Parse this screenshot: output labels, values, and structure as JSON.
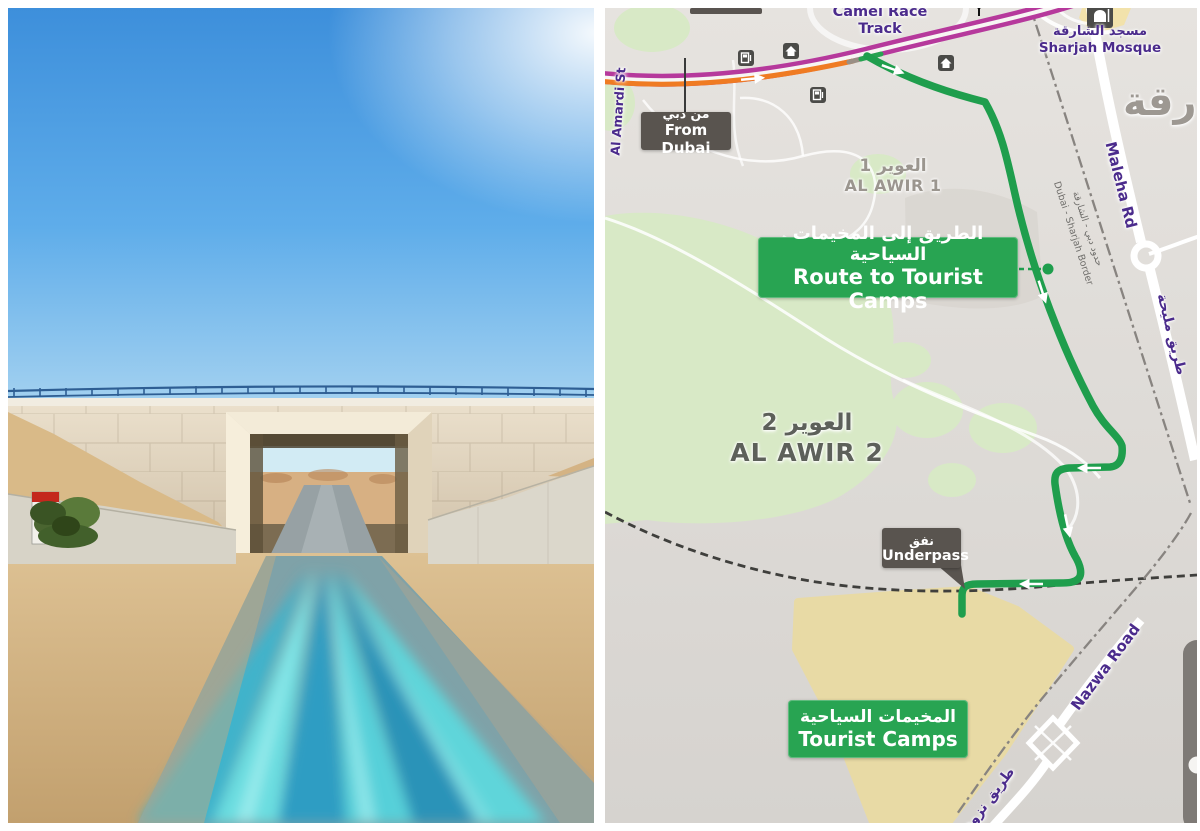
{
  "panels": {
    "left": "road-photo",
    "right": "route-map"
  },
  "photo": {
    "scene": "desert road passing under a highway bridge, motion-blurred cyan road, clear blue sky",
    "colors": {
      "sky_top": "#3d8fdb",
      "sky_horizon": "#a5d2f0",
      "bridge_wall": "#eadfcb",
      "sand": "#d5b586",
      "road_blur_cyan": "#3fb3cb",
      "railing_blue": "#2e5e93",
      "sign_red": "#c4271d",
      "bush_green": "#4a6530"
    }
  },
  "map": {
    "colors": {
      "background": "#e3e0dc",
      "greenery": "#d8e9c6",
      "camp_area": "#e8daa5",
      "route_green": "#1f9e4d",
      "highway_magenta": "#b6399c",
      "traffic_orange": "#ef7b23",
      "label_purple": "#4b2b8c",
      "box_green": "#28a452",
      "box_dark": "#59544f",
      "area_label_gray": "#9b968f",
      "poi_yellow": "#f2e2ab"
    },
    "labels": {
      "camel_race_track": "Camel Race Track",
      "sharjah_mosque_ar": "مسجد الشارقة",
      "sharjah_mosque_en": "Sharjah Mosque",
      "sharjah_city_partial": "ارقة",
      "from_dubai_ar": "من دبي",
      "from_dubai_en": "From Dubai",
      "al_amardi_st": "Al Amardi St",
      "al_awir_1_ar": "العوير 1",
      "al_awir_1_en": "AL AWIR 1",
      "route_to_camps_ar": "الطريق إلى المخيمات السياحية",
      "route_to_camps_en": "Route to Tourist Camps",
      "al_awir_2_ar": "العوير 2",
      "al_awir_2_en": "AL AWIR 2",
      "border_ar": "حدود دبي - الشارقة",
      "border_en": "Dubai - Sharjah Border",
      "maleha_rd_en": "Maleha Rd",
      "maleha_rd_ar": "طريق مليحة",
      "underpass_ar": "نفق",
      "underpass_en": "Underpass",
      "tourist_camps_ar": "المخيمات السياحية",
      "tourist_camps_en": "Tourist Camps",
      "nazwa_road_en": "Nazwa Road",
      "nazwa_road_ar": "طريق نزوى"
    },
    "icons": [
      {
        "name": "fuel-station-icon",
        "count": 2
      },
      {
        "name": "house-icon",
        "count": 2
      },
      {
        "name": "mosque-icon",
        "count": 1
      }
    ]
  }
}
